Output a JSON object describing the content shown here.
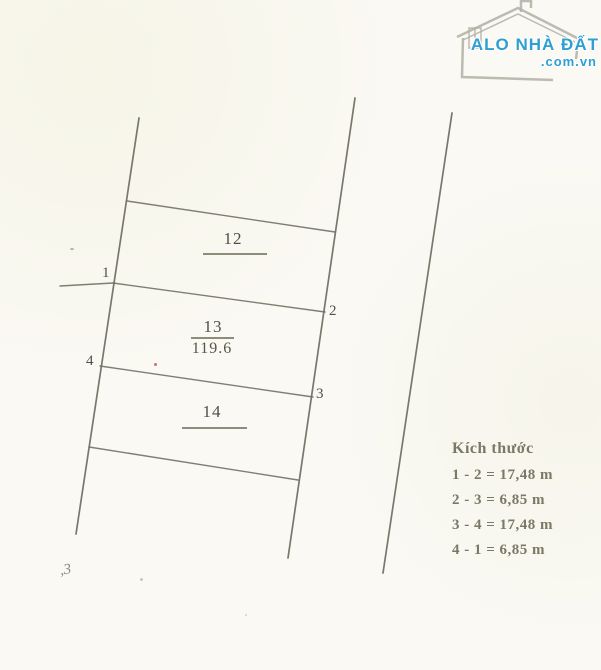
{
  "logo": {
    "title": "ALO NHÀ ĐẤT",
    "subtitle": ".com.vn",
    "brand_color": "#2e9ed3"
  },
  "plots": {
    "p12": {
      "number": "12"
    },
    "p13": {
      "number": "13",
      "area": "119.6"
    },
    "p14": {
      "number": "14"
    }
  },
  "corner_points": {
    "p1": {
      "label": "1"
    },
    "p2": {
      "label": "2"
    },
    "p3": {
      "label": "3"
    },
    "p4": {
      "label": "4"
    }
  },
  "legend": {
    "title": "Kích thước",
    "entries": [
      "1 - 2 = 17,48 m",
      "2 - 3 = 6,85 m",
      "3 - 4 = 17,48 m",
      "4 - 1 = 6,85 m"
    ]
  },
  "annotations": {
    "scribble": ",3"
  },
  "colors": {
    "background": "#faf9f3",
    "line": "#6e6c61",
    "text": "#55534a",
    "legend_text": "#7b7865",
    "red_mark": "#c0392b"
  }
}
